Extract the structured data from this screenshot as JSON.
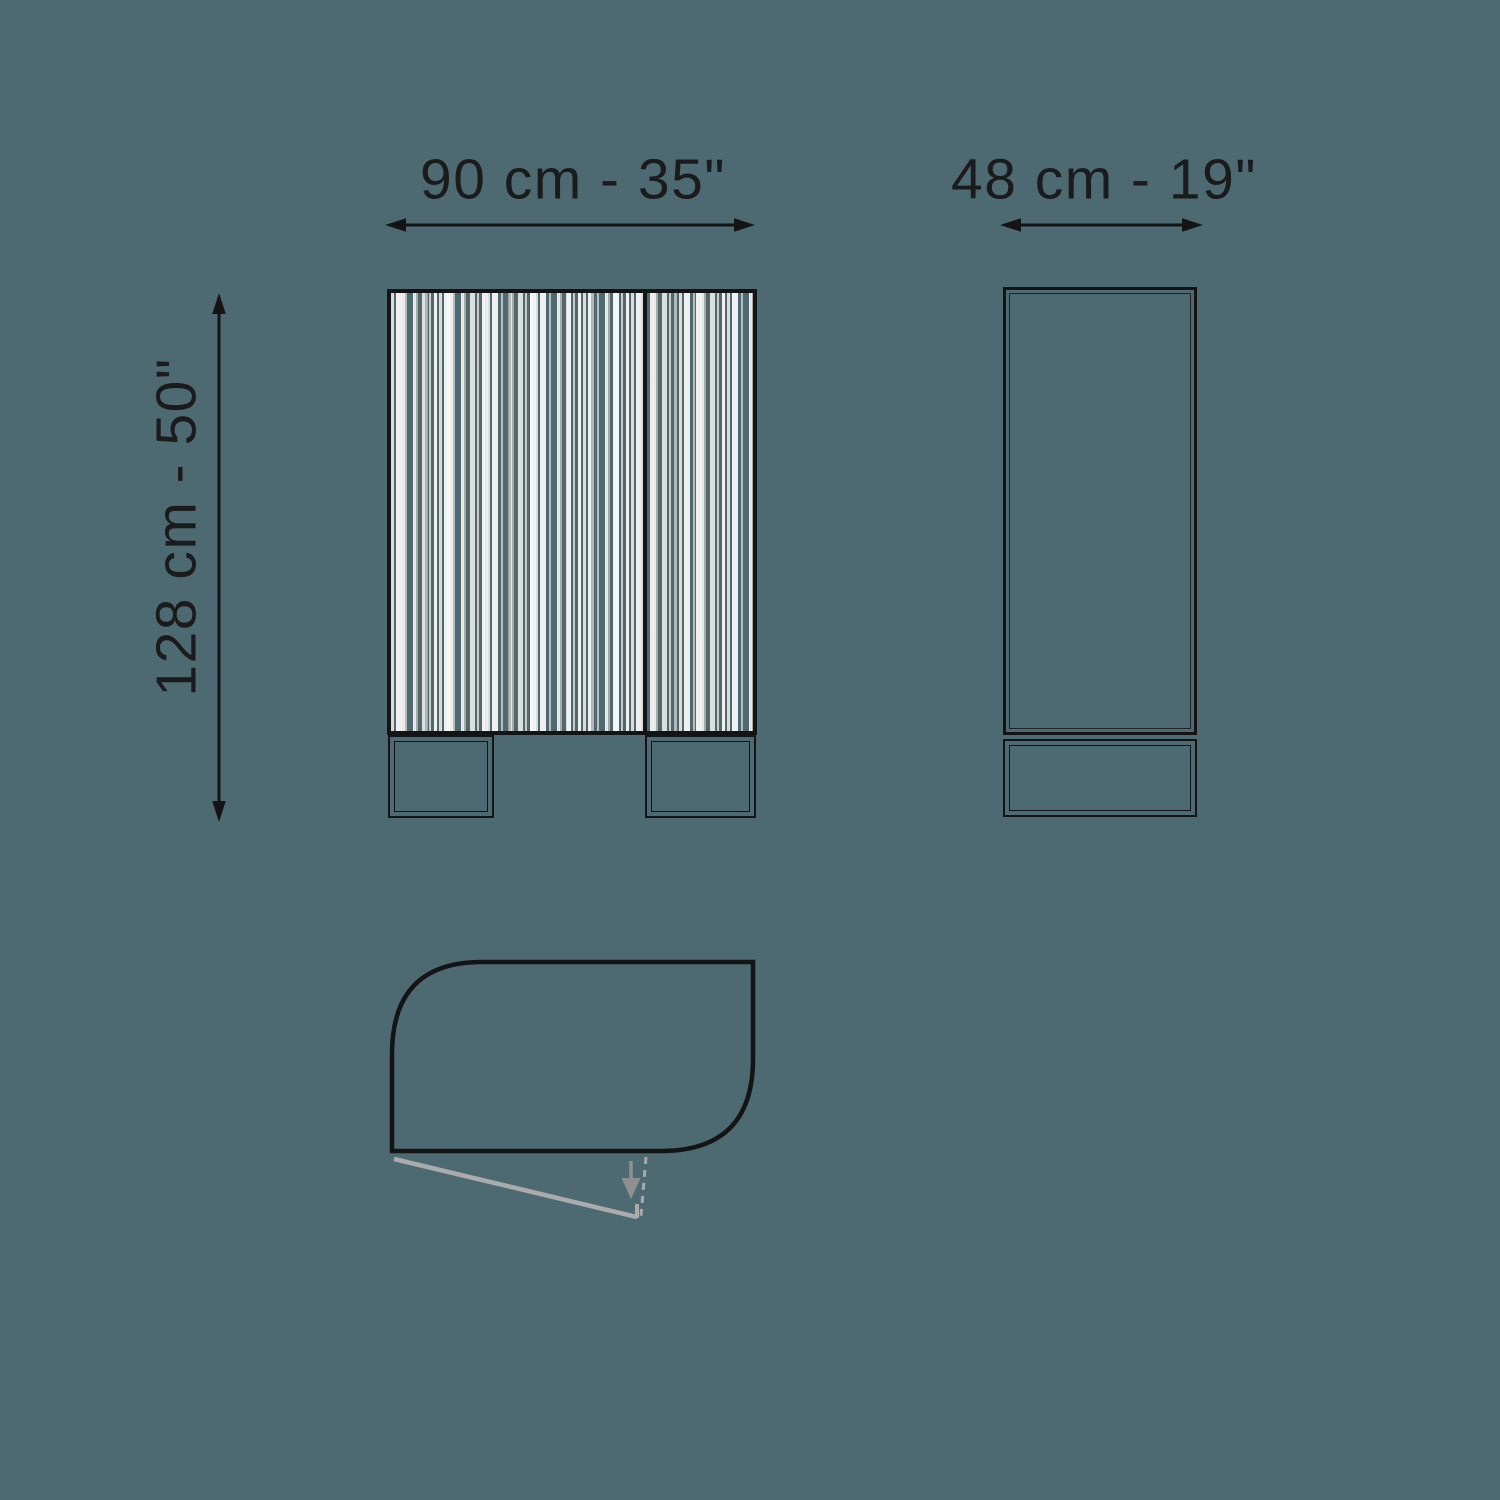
{
  "page": {
    "background_color": "#4d6a72",
    "ink_color": "#141414",
    "swing_line_color": "#ababab",
    "swing_arrow_color": "#8f8f8f",
    "flute_stripe_colors": [
      "#f2f1ee",
      "#dededb",
      "#c9c9c7",
      "#a8a9a7"
    ]
  },
  "drawing": {
    "dimensions": {
      "width": {
        "label": "90 cm - 35\""
      },
      "depth": {
        "label": "48 cm - 19\""
      },
      "height": {
        "label": "128 cm - 50\""
      }
    }
  }
}
